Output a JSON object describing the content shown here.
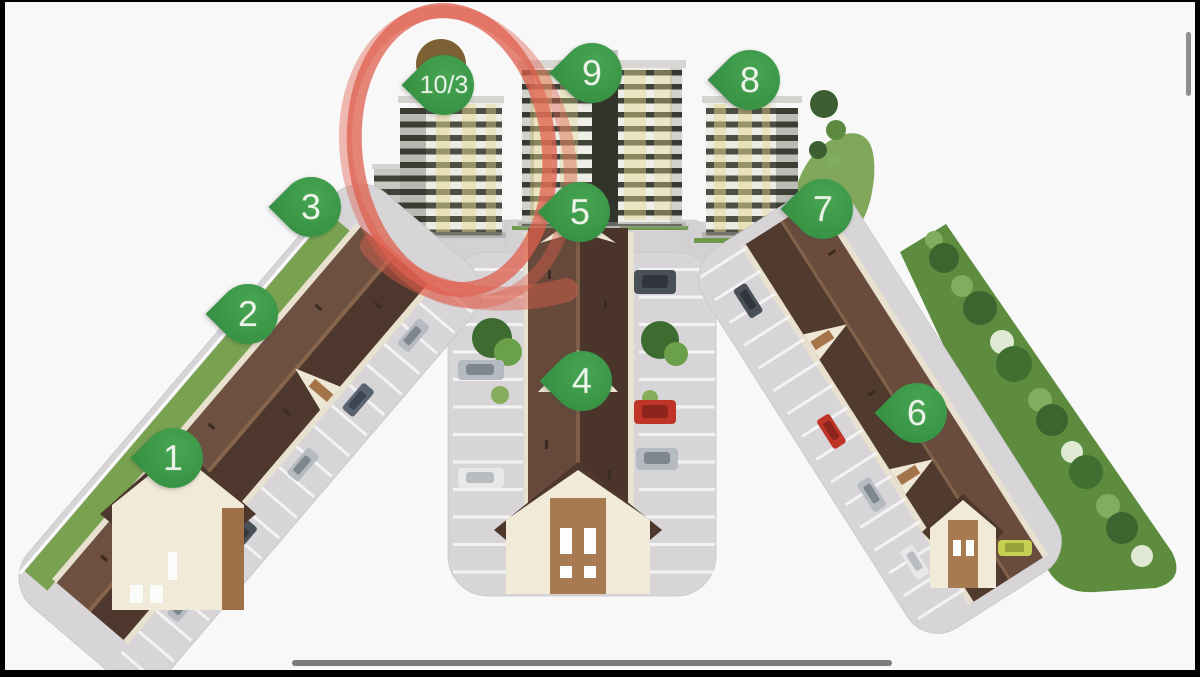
{
  "view": {
    "kind": "image-viewer-frame",
    "background_color": "#f8f8f8",
    "frame_edge_color": "#000000",
    "progress_bar_color": "#7d7a7e",
    "scroll_indicator_color": "#8f8d8f"
  },
  "site_plan": {
    "description": "3D aerial rendering of a residential complex with three townhouse rows, three apartment towers, parking lots and a tree strip",
    "pin_color": "#3d9d4a",
    "pin_label_color": "#eef4ea",
    "pins": [
      {
        "id": "1",
        "label": "1",
        "x": 173,
        "y": 500
      },
      {
        "id": "2",
        "label": "2",
        "x": 248,
        "y": 356
      },
      {
        "id": "3",
        "label": "3",
        "x": 311,
        "y": 249
      },
      {
        "id": "4",
        "label": "4",
        "x": 582,
        "y": 423
      },
      {
        "id": "5",
        "label": "5",
        "x": 580,
        "y": 254
      },
      {
        "id": "6",
        "label": "6",
        "x": 917,
        "y": 455
      },
      {
        "id": "7",
        "label": "7",
        "x": 823,
        "y": 251
      },
      {
        "id": "8",
        "label": "8",
        "x": 750,
        "y": 122
      },
      {
        "id": "9",
        "label": "9",
        "x": 592,
        "y": 115
      },
      {
        "id": "10-3",
        "label": "10/3",
        "x": 444,
        "y": 127,
        "wide": true
      }
    ],
    "annotation": {
      "type": "hand-drawn-circle",
      "color": "#df5f4e",
      "highlights_pin": "10/3"
    }
  }
}
